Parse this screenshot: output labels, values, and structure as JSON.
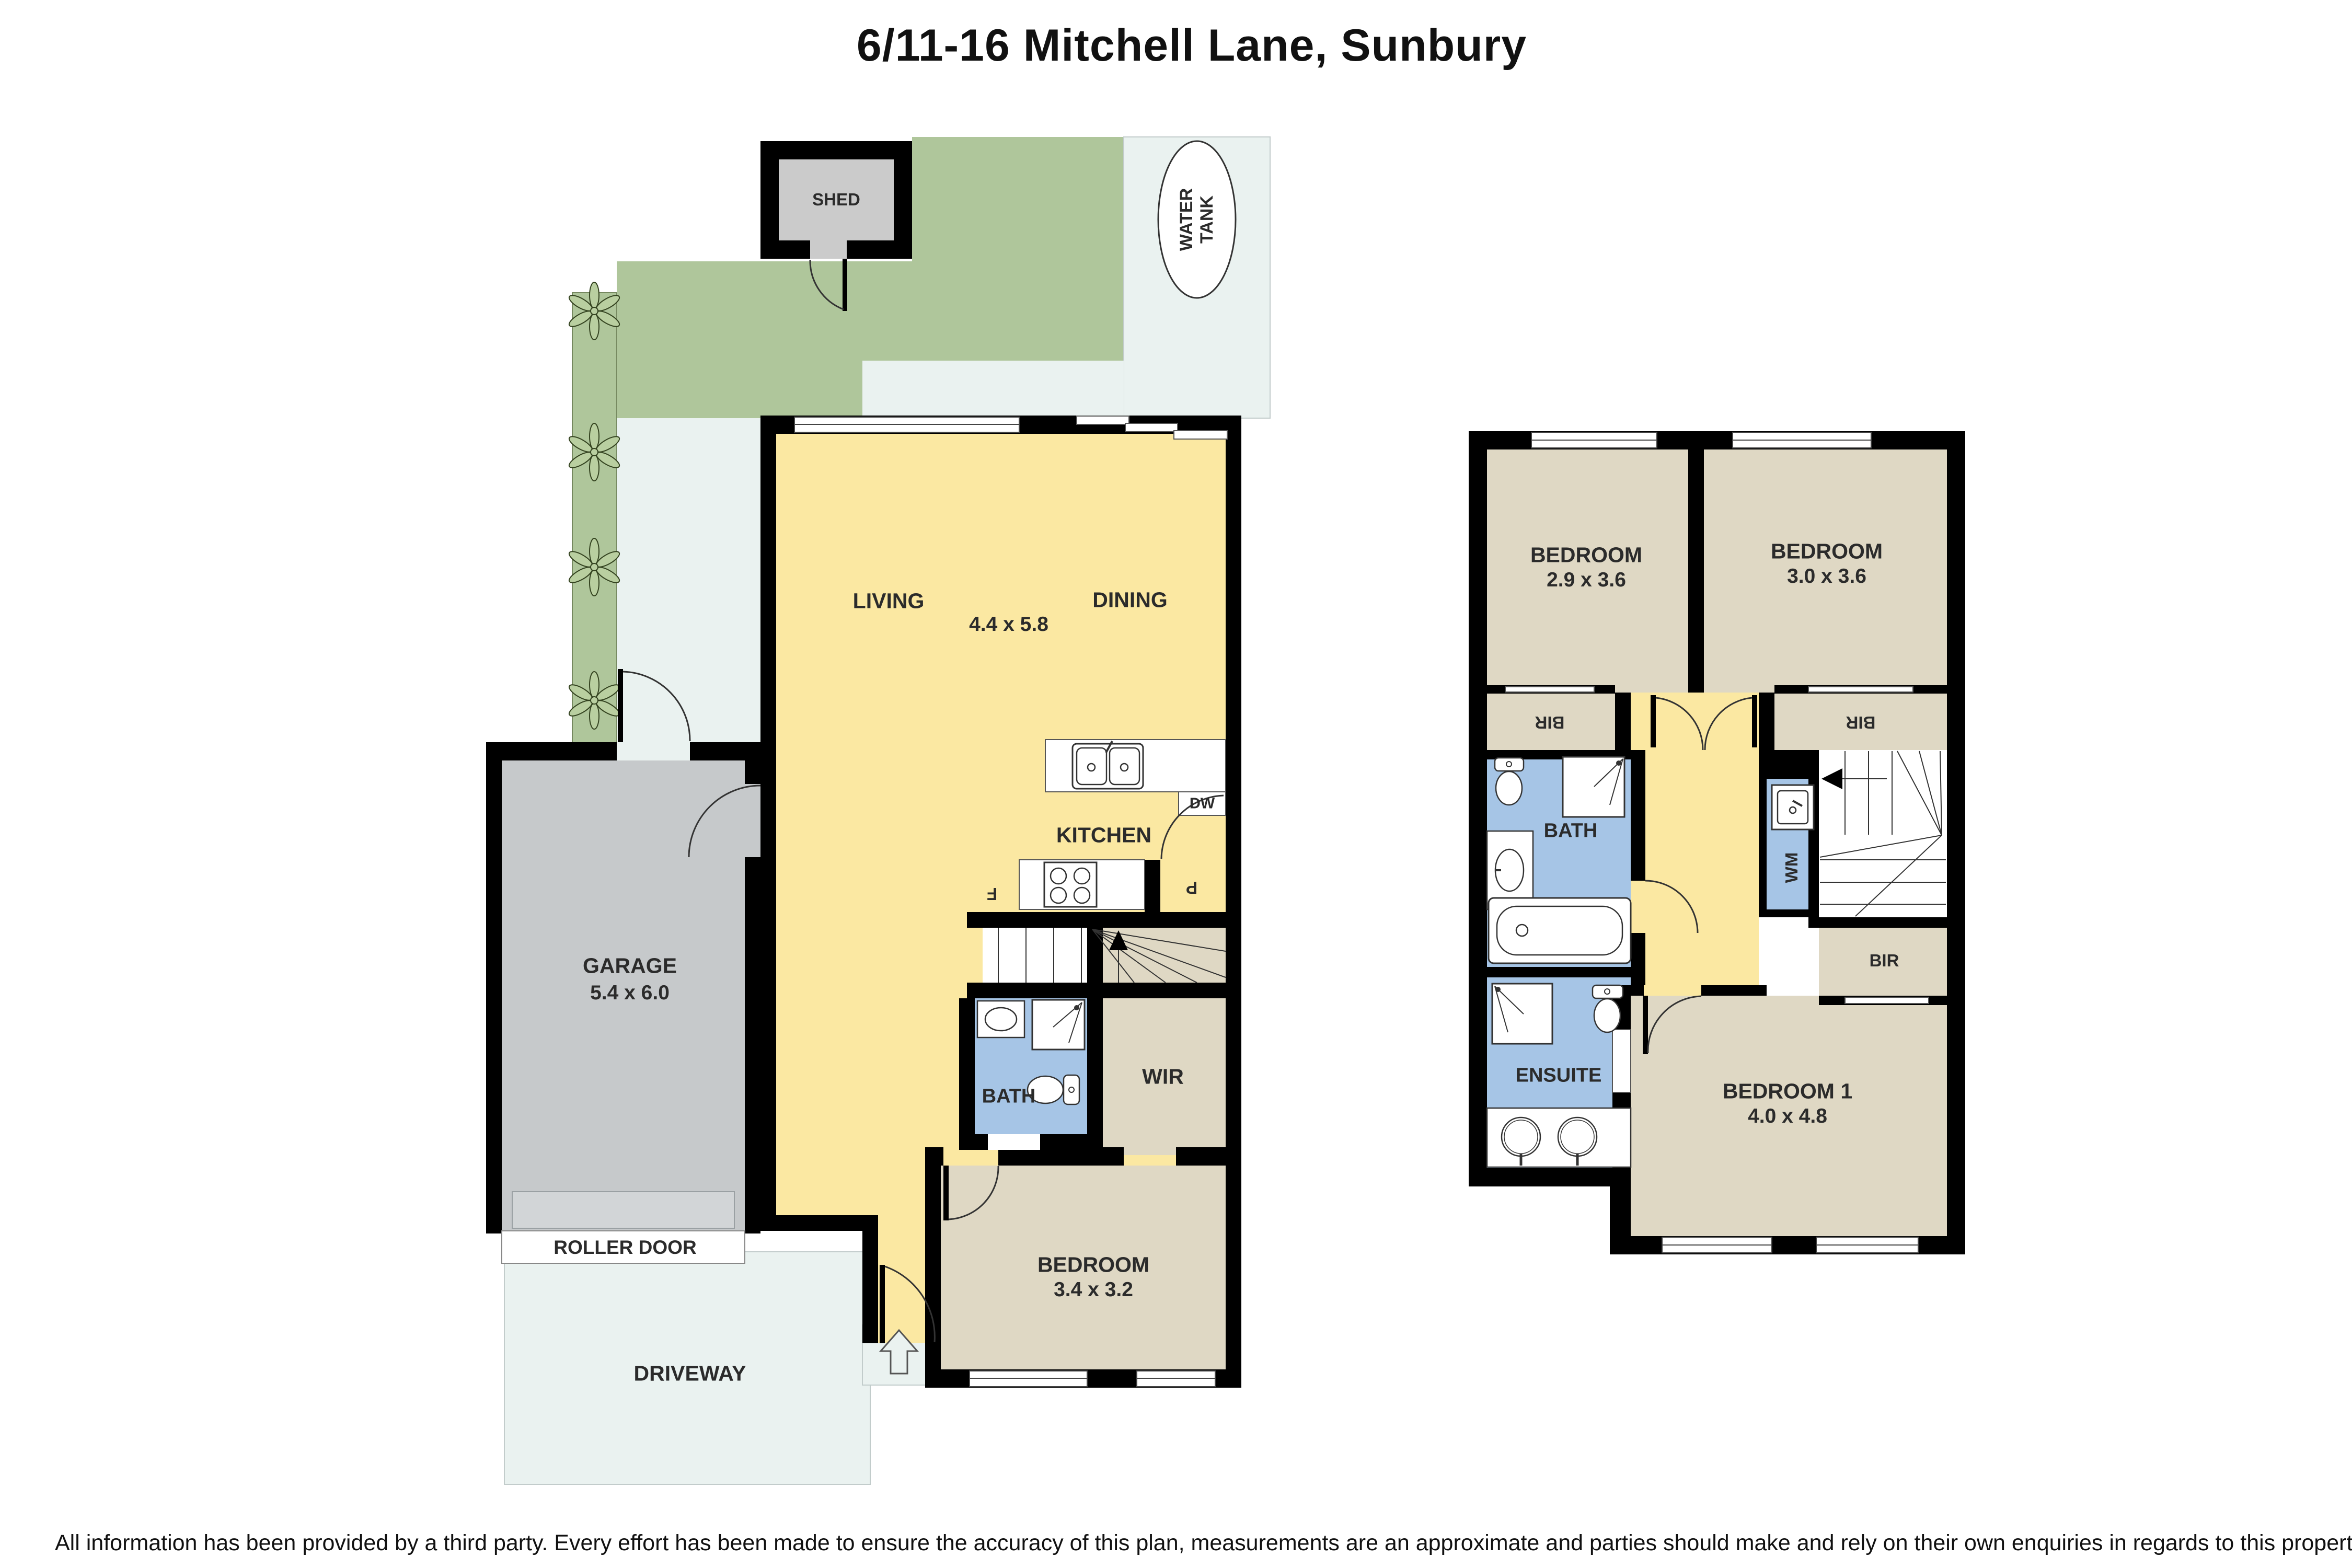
{
  "title": "6/11-16 Mitchell Lane, Sunbury",
  "disclaimer": "All information has been provided by a third party. Every effort has been made to ensure the accuracy of this plan, measurements are an approximate and parties should make and rely on their own enquiries in regards to this property.",
  "colors": {
    "wall": "#000000",
    "living_yellow": "#FBE8A2",
    "bedroom_beige": "#DFD8C4",
    "bathroom_blue": "#A6C5E6",
    "garden_green": "#AFC69B",
    "outdoor_light": "#EAF2F0",
    "garage_grey": "#C6C9CB",
    "shed_grey": "#CBCBCB",
    "label_text": "#2B2B2B"
  },
  "ground_floor": {
    "shed": "SHED",
    "water_tank": "WATER TANK",
    "living": "LIVING",
    "dining": "DINING",
    "living_dining_dims": "4.4 x 5.8",
    "kitchen": "KITCHEN",
    "dishwasher": "DW",
    "fridge": "F",
    "pantry": "P",
    "garage": "GARAGE",
    "garage_dims": "5.4 x 6.0",
    "roller_door": "ROLLER DOOR",
    "driveway": "DRIVEWAY",
    "bath": "BATH",
    "wir": "WIR",
    "bedroom": "BEDROOM",
    "bedroom_dims": "3.4 x 3.2"
  },
  "upper_floor": {
    "bedroom_left": "BEDROOM",
    "bedroom_left_dims": "2.9 x 3.6",
    "bedroom_right": "BEDROOM",
    "bedroom_right_dims": "3.0 x 3.6",
    "bir_left": "BIR",
    "bir_right": "BIR",
    "bath": "BATH",
    "wm": "WM",
    "bir_stairs": "BIR",
    "ensuite": "ENSUITE",
    "bedroom1": "BEDROOM 1",
    "bedroom1_dims": "4.0 x 4.8"
  }
}
